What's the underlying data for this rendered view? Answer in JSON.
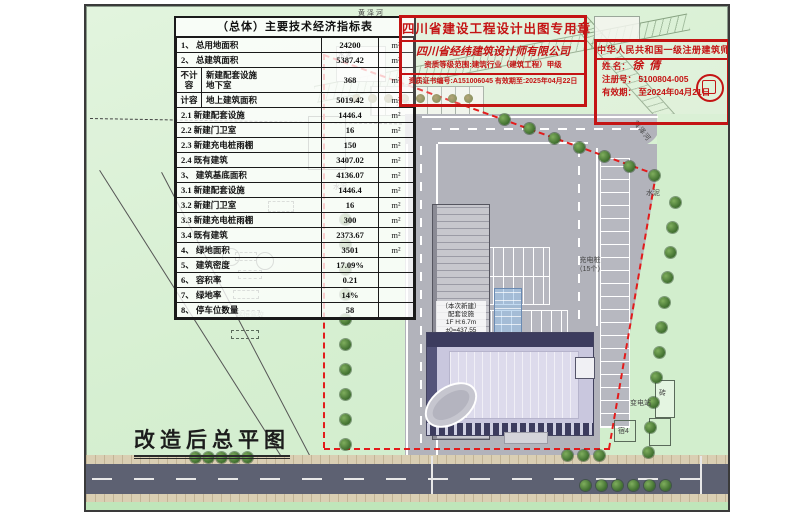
{
  "table": {
    "title": "（总体）主要技术经济指标表",
    "rows": [
      {
        "name": "1、 总用地面积",
        "value": "24200",
        "unit": "m²"
      },
      {
        "name": "2、 总建筑面积",
        "value": "5387.42",
        "unit": "m²"
      },
      {
        "prefix": "不计容",
        "name": "新建配套设施\n地下室",
        "value": "368",
        "unit": "m²"
      },
      {
        "prefix": "计容",
        "name": "地上建筑面积",
        "value": "5019.42",
        "unit": "m²"
      },
      {
        "name": "2.1  新建配套设施",
        "value": "1446.4",
        "unit": "m²"
      },
      {
        "name": "2.2  新建门卫室",
        "value": "16",
        "unit": "m²"
      },
      {
        "name": "2.3  新建充电桩雨棚",
        "value": "150",
        "unit": "m²"
      },
      {
        "name": "2.4  既有建筑",
        "value": "3407.02",
        "unit": "m²"
      },
      {
        "name": "3、 建筑基底面积",
        "value": "4136.07",
        "unit": "m²"
      },
      {
        "name": "3.1  新建配套设施",
        "value": "1446.4",
        "unit": "m²"
      },
      {
        "name": "3.2  新建门卫室",
        "value": "16",
        "unit": "m²"
      },
      {
        "name": "3.3  新建充电桩雨棚",
        "value": "300",
        "unit": "m²"
      },
      {
        "name": "3.4  既有建筑",
        "value": "2373.67",
        "unit": "m²"
      },
      {
        "name": "4、 绿地面积",
        "value": "3501",
        "unit": "m²"
      },
      {
        "name": "5、 建筑密度",
        "value": "17.09%",
        "unit": ""
      },
      {
        "name": "6、 容积率",
        "value": "0.21",
        "unit": ""
      },
      {
        "name": "7、 绿地率",
        "value": "14%",
        "unit": ""
      },
      {
        "name": "8、 停车位数量",
        "value": "58",
        "unit": ""
      }
    ]
  },
  "stamps": {
    "design_seal": {
      "title": "四川省建设工程设计出图专用章",
      "company": "四川省经纬建筑设计师有限公司",
      "scope": "资质等级范围:建筑行业（建筑工程）甲级",
      "cert": "资质证书编号:A151006045  有效期至:2025年04月22日"
    },
    "architect_seal": {
      "title": "中华人民共和国一级注册建筑师",
      "name_label": "姓  名：",
      "name": "徐倩",
      "reg_label": "注册号：",
      "reg_no": "5100804-005",
      "valid_label": "有效期：",
      "valid": "至2024年04月21日"
    }
  },
  "plan": {
    "title": "改造后总平图",
    "labels": {
      "river": "黄泽河",
      "cement": "水泥",
      "charging_1": "充电桩",
      "charging_2": "（15个）",
      "substation": "变电站",
      "brick": "砖",
      "dorm": "宿4",
      "school": "铭恒驾校",
      "annex_1": "（本次新建）",
      "annex_2": "配套设施",
      "annex_3": "1F H:6.7m",
      "annex_4": "±0=437.55"
    }
  },
  "colors": {
    "stamp_red": "#c41414",
    "boundary_red": "#e31b1b",
    "site_green": "#d6efd1",
    "paving_grey": "#b2b3bb",
    "building_lavender": "#c9c7de",
    "building_navy": "#3c3c5e",
    "road_dark": "#5d6172",
    "sidewalk_tan": "#dacfb3"
  }
}
